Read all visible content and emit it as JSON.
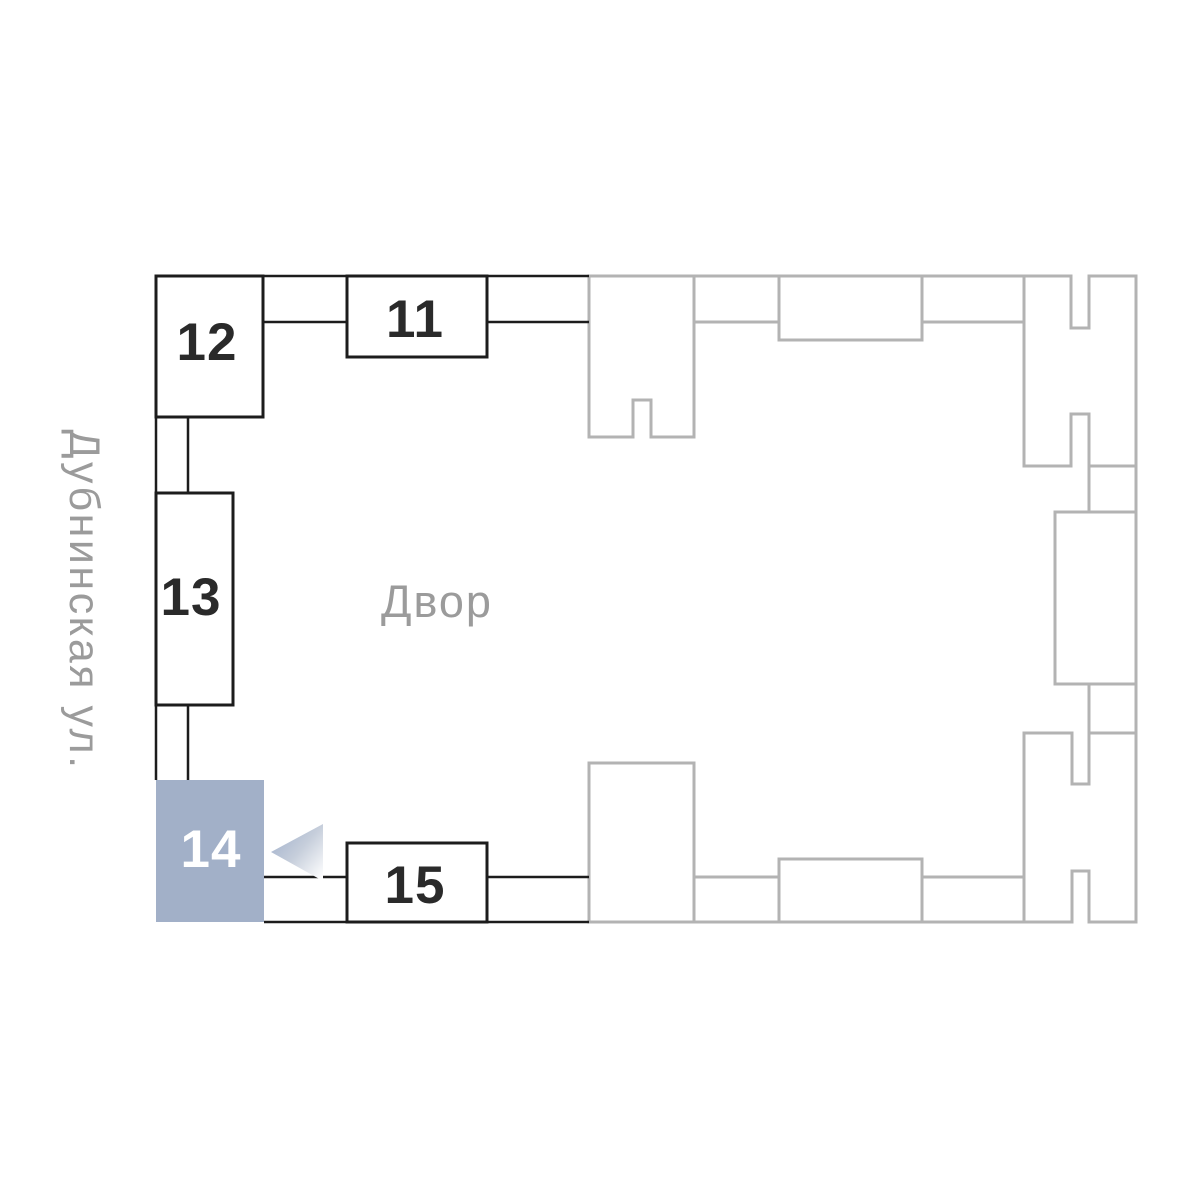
{
  "street": {
    "label": "Дубнинская ул."
  },
  "courtyard": {
    "label": "Двор"
  },
  "buildings": {
    "b11": {
      "label": "11",
      "state": "default"
    },
    "b12": {
      "label": "12",
      "state": "default"
    },
    "b13": {
      "label": "13",
      "state": "default"
    },
    "b14": {
      "label": "14",
      "state": "selected"
    },
    "b15": {
      "label": "15",
      "state": "default"
    }
  },
  "colors": {
    "selected_fill": "#a2b0c8",
    "selected_text": "#ffffff",
    "outline_dark": "#1c1c1c",
    "outline_gray": "#b3b3b3",
    "label_gray": "#9b9b9b",
    "number_dark": "#2a2a2a",
    "pointer_gradient_start": "#9fafcb",
    "pointer_gradient_end": "#ffffff"
  },
  "icons": {
    "selection_pointer": "left-pointing-triangle"
  }
}
